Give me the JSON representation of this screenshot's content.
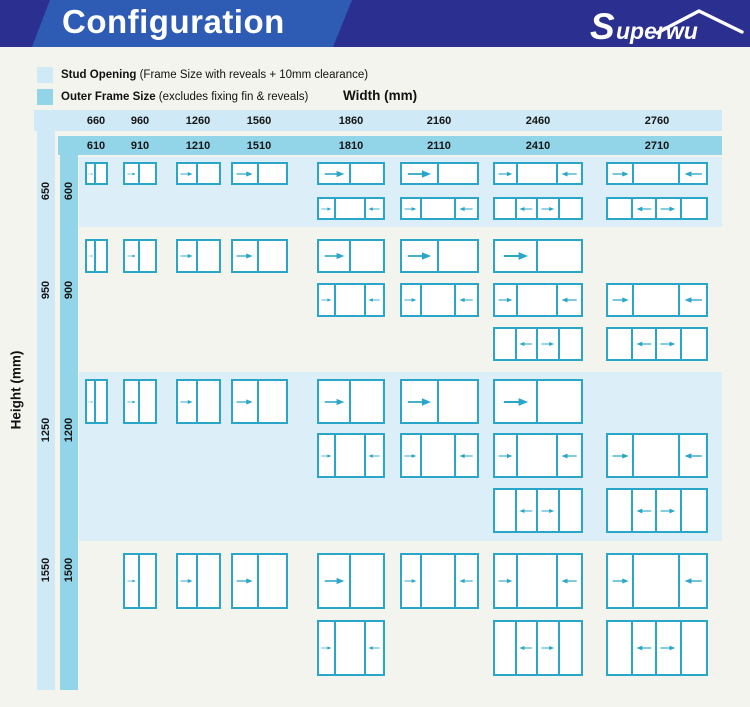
{
  "header": {
    "title": "Configuration",
    "brand": "Superwu"
  },
  "legend": {
    "items": [
      {
        "label": "Stud Opening",
        "desc": "(Frame Size with reveals + 10mm clearance)",
        "swatch": "#cfe9f6"
      },
      {
        "label": "Outer Frame Size",
        "desc": "(excludes fixing fin & reveals)",
        "swatch": "#93d5e8"
      }
    ]
  },
  "axes": {
    "width_label": "Width (mm)",
    "height_label": "Height (mm)"
  },
  "colors": {
    "bar": "#2b2f90",
    "slash": "#2e5cb5",
    "accent": "#29a6c8",
    "band": "#dceff8",
    "strip_light": "#cfe9f6",
    "strip_mid": "#93d5e8",
    "page_bg": "#f4f4ee"
  },
  "chart_data": {
    "type": "table",
    "title": "Configuration",
    "columns": [
      {
        "stud": "660",
        "frame": "610"
      },
      {
        "stud": "960",
        "frame": "910"
      },
      {
        "stud": "1260",
        "frame": "1210"
      },
      {
        "stud": "1560",
        "frame": "1510"
      },
      {
        "stud": "1860",
        "frame": "1810"
      },
      {
        "stud": "2160",
        "frame": "2110"
      },
      {
        "stud": "2460",
        "frame": "2410"
      },
      {
        "stud": "2760",
        "frame": "2710"
      }
    ],
    "rows": [
      {
        "stud": "650",
        "frame": "600",
        "subrows": [
          {
            "cells": [
              [
                0,
                [
                  "R",
                  "-"
                ]
              ],
              [
                1,
                [
                  "R",
                  "-"
                ]
              ],
              [
                2,
                [
                  "R",
                  "-"
                ]
              ],
              [
                3,
                [
                  "R",
                  "-"
                ]
              ],
              [
                4,
                [
                  "R",
                  "-"
                ]
              ],
              [
                5,
                [
                  "R",
                  "-"
                ]
              ],
              [
                6,
                [
                  "R",
                  "-",
                  "L"
                ]
              ],
              [
                7,
                [
                  "R",
                  "-",
                  "L"
                ]
              ]
            ]
          },
          {
            "cells": [
              [
                4,
                [
                  "R",
                  "-",
                  "L"
                ]
              ],
              [
                5,
                [
                  "R",
                  "-",
                  "L"
                ]
              ],
              [
                6,
                [
                  "-",
                  "L",
                  "R",
                  "-"
                ]
              ],
              [
                7,
                [
                  "-",
                  "L",
                  "R",
                  "-"
                ]
              ]
            ]
          }
        ]
      },
      {
        "stud": "950",
        "frame": "900",
        "subrows": [
          {
            "cells": [
              [
                0,
                [
                  "R",
                  "-"
                ]
              ],
              [
                1,
                [
                  "R",
                  "-"
                ]
              ],
              [
                2,
                [
                  "R",
                  "-"
                ]
              ],
              [
                3,
                [
                  "R",
                  "-"
                ]
              ],
              [
                4,
                [
                  "R",
                  "-"
                ]
              ],
              [
                5,
                [
                  "R",
                  "-"
                ]
              ],
              [
                6,
                [
                  "R",
                  "-"
                ]
              ]
            ]
          },
          {
            "cells": [
              [
                4,
                [
                  "R",
                  "-",
                  "L"
                ]
              ],
              [
                5,
                [
                  "R",
                  "-",
                  "L"
                ]
              ],
              [
                6,
                [
                  "R",
                  "-",
                  "L"
                ]
              ],
              [
                7,
                [
                  "R",
                  "-",
                  "L"
                ]
              ]
            ]
          },
          {
            "cells": [
              [
                6,
                [
                  "-",
                  "L",
                  "R",
                  "-"
                ]
              ],
              [
                7,
                [
                  "-",
                  "L",
                  "R",
                  "-"
                ]
              ]
            ]
          }
        ]
      },
      {
        "stud": "1250",
        "frame": "1200",
        "subrows": [
          {
            "cells": [
              [
                0,
                [
                  "R",
                  "-"
                ]
              ],
              [
                1,
                [
                  "R",
                  "-"
                ]
              ],
              [
                2,
                [
                  "R",
                  "-"
                ]
              ],
              [
                3,
                [
                  "R",
                  "-"
                ]
              ],
              [
                4,
                [
                  "R",
                  "-"
                ]
              ],
              [
                5,
                [
                  "R",
                  "-"
                ]
              ],
              [
                6,
                [
                  "R",
                  "-"
                ]
              ]
            ]
          },
          {
            "cells": [
              [
                4,
                [
                  "R",
                  "-",
                  "L"
                ]
              ],
              [
                5,
                [
                  "R",
                  "-",
                  "L"
                ]
              ],
              [
                6,
                [
                  "R",
                  "-",
                  "L"
                ]
              ],
              [
                7,
                [
                  "R",
                  "-",
                  "L"
                ]
              ]
            ]
          },
          {
            "cells": [
              [
                6,
                [
                  "-",
                  "L",
                  "R",
                  "-"
                ]
              ],
              [
                7,
                [
                  "-",
                  "L",
                  "R",
                  "-"
                ]
              ]
            ]
          }
        ]
      },
      {
        "stud": "1550",
        "frame": "1500",
        "subrows": [
          {
            "cells": [
              [
                1,
                [
                  "R",
                  "-"
                ]
              ],
              [
                2,
                [
                  "R",
                  "-"
                ]
              ],
              [
                3,
                [
                  "R",
                  "-"
                ]
              ],
              [
                4,
                [
                  "R",
                  "-"
                ]
              ],
              [
                5,
                [
                  "R",
                  "-",
                  "L"
                ]
              ],
              [
                6,
                [
                  "R",
                  "-",
                  "L"
                ]
              ],
              [
                7,
                [
                  "R",
                  "-",
                  "L"
                ]
              ]
            ]
          },
          {
            "cells": [
              [
                4,
                [
                  "R",
                  "-",
                  "L"
                ]
              ],
              [
                6,
                [
                  "-",
                  "L",
                  "R",
                  "-"
                ]
              ],
              [
                7,
                [
                  "-",
                  "L",
                  "R",
                  "-"
                ]
              ]
            ]
          }
        ]
      }
    ],
    "legend_note": "R = panel slides right, L = panel slides left, - = fixed panel"
  }
}
